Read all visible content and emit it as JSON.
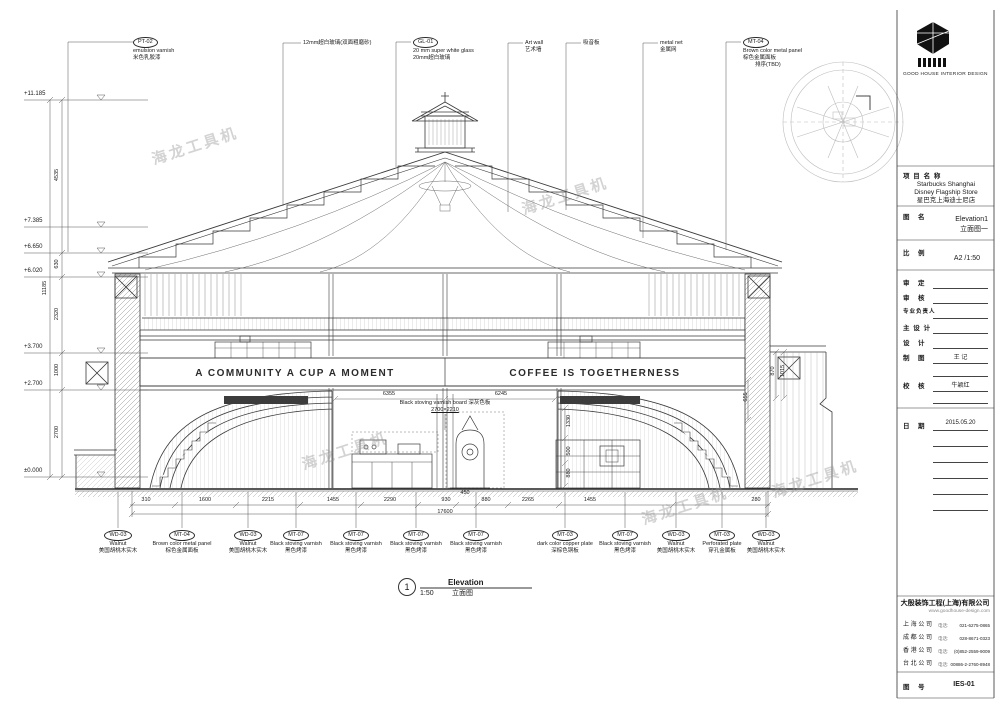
{
  "sheet": {
    "watermark_text": "海龙工具机",
    "logo": {
      "company_en": "GOOD HOUSE INTERIOR DESIGN"
    },
    "top_callouts": [
      {
        "code": "PT-02",
        "en": "emulsion varnish",
        "cn": "米色乳胶漆"
      },
      {
        "code": "",
        "en": "",
        "cn": "12mm超白玻璃(双面粗磨砂)"
      },
      {
        "code": "GL-01",
        "en": "20 mm super white glass",
        "cn": "20mm超白玻璃"
      },
      {
        "code": "",
        "en": "Art wall",
        "cn": "艺术墙"
      },
      {
        "code": "",
        "en": "",
        "cn": "吸音板"
      },
      {
        "code": "",
        "en": "metal net",
        "cn": "金属网"
      },
      {
        "code": "MT-04",
        "en": "Brown color metal panel",
        "cn": "棕色金属面板",
        "note": "排序(TBD)"
      }
    ],
    "bottom_callouts": [
      {
        "code": "WD-03",
        "en": "Walnut",
        "cn": "美国胡桃木实木"
      },
      {
        "code": "MT-04",
        "en": "Brown color metal panel",
        "cn": "棕色金属面板"
      },
      {
        "code": "WD-03",
        "en": "Walnut",
        "cn": "美国胡桃木实木"
      },
      {
        "code": "MT-07",
        "en": "Black stoving varnish",
        "cn": "黑色烤漆"
      },
      {
        "code": "MT-07",
        "en": "Black stoving varnish",
        "cn": "黑色烤漆"
      },
      {
        "code": "MT-07",
        "en": "Black stoving varnish",
        "cn": "黑色烤漆"
      },
      {
        "code": "MT-07",
        "en": "Black stoving varnish",
        "cn": "黑色烤漆"
      },
      {
        "code": "MT-03",
        "en": "dark color copper plate",
        "cn": "深棕色铜板"
      },
      {
        "code": "MT-07",
        "en": "Black stoving varnish",
        "cn": "黑色烤漆"
      },
      {
        "code": "WD-03",
        "en": "Walnut",
        "cn": "美国胡桃木实木"
      },
      {
        "code": "MT-03",
        "en": "Perforated plate",
        "cn": "穿孔金属板"
      },
      {
        "code": "WD-03",
        "en": "Walnut",
        "cn": "美国胡桃木实木"
      }
    ],
    "levels": [
      "+11.185",
      "+7.385",
      "+6.650",
      "+6.020",
      "+3.700",
      "+2.700",
      "±0.000"
    ],
    "v_dims": [
      "4535",
      "630",
      "2320",
      "1000",
      "2700"
    ],
    "v_total": "11185",
    "h_dims": [
      "310",
      "1600",
      "2215",
      "1455",
      "2290",
      "930",
      "450",
      "880",
      "2265",
      "1455",
      "280"
    ],
    "h_total": "17600",
    "banner": {
      "left": "A COMMUNITY  A CUP  A MOMENT",
      "right": "COFFEE  IS  TOGETHERNESS"
    },
    "interior": {
      "board_note": "Black stoving varnish board 深灰色板",
      "board_dim": "2700×2210",
      "dim_left_width": "6355",
      "dim_right_width": "6245",
      "chain_1": "1330",
      "chain_2": "500",
      "chain_3": "880",
      "wall_1": "870",
      "wall_2": "1015",
      "wall_3": "655"
    },
    "view_title": {
      "number": "1",
      "scale": "1:50",
      "en": "Elevation",
      "cn": "立面图"
    },
    "title_block": {
      "project_label": "项 目 名 称",
      "project_en1": "Starbucks Shanghai",
      "project_en2": "Disney Flagship Store",
      "project_cn": "星巴克上海迪士尼店",
      "drawing_label": "图　名",
      "drawing_en": "Elevation1",
      "drawing_cn": "立面图一",
      "scale_label": "比　例",
      "scale_value": "A2 /1:50",
      "sign_rows": [
        {
          "label": "审　定",
          "value": ""
        },
        {
          "label": "审　核",
          "value": ""
        },
        {
          "label": "专业负责人",
          "value": ""
        },
        {
          "label": "主 设 计",
          "value": ""
        },
        {
          "label": "设　计",
          "value": ""
        },
        {
          "label": "制　图",
          "value": "王 记"
        },
        {
          "label": "校　核",
          "value": "牛颖红"
        }
      ],
      "date_label": "日　期",
      "date_value": "2015.05.20",
      "company_cn": "大殷装饰工程(上海)有限公司",
      "company_web": "www.goodhouse-design.com",
      "tel_label": "电话:",
      "offices": [
        {
          "name": "上 海 公 司",
          "tel": "021-6275-0865"
        },
        {
          "name": "成 都 公 司",
          "tel": "028-8671-0323"
        },
        {
          "name": "香 港 公 司",
          "tel": "(0)852-2559-9009"
        },
        {
          "name": "台 北 公 司",
          "tel": "00886-2-2760-8948"
        }
      ],
      "number_label": "图　号",
      "number_value": "IES-01"
    }
  }
}
